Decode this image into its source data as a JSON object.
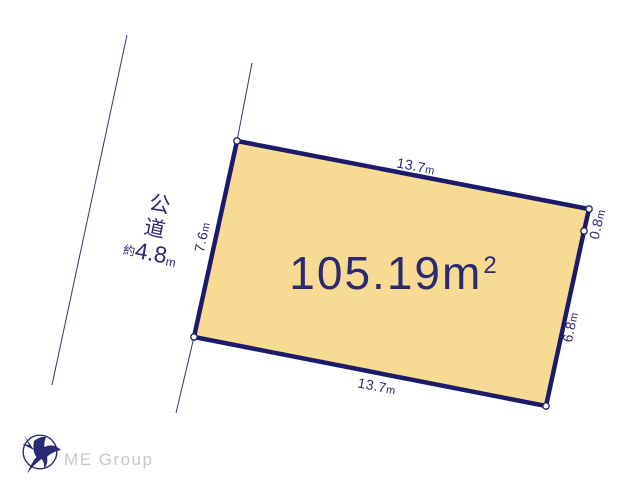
{
  "diagram": {
    "parcel": {
      "area_number": "105.19",
      "area_unit": "m",
      "area_exponent": "2",
      "fill_color": "#F8DA92",
      "outline_color": "#1B1B6B",
      "dimensions": {
        "top": {
          "number": "13.7",
          "unit": "m"
        },
        "right_upper": {
          "number": "0.8",
          "unit": "m"
        },
        "right_lower": {
          "number": "6.8",
          "unit": "m"
        },
        "bottom": {
          "number": "13.7",
          "unit": "m"
        },
        "left": {
          "number": "7.6",
          "unit": "m"
        }
      }
    },
    "road": {
      "name": "公道",
      "width_prefix": "約",
      "width_number": "4.8",
      "width_unit": "m"
    }
  },
  "footer": {
    "company": "ME Group"
  },
  "colors": {
    "ink_navy": "#2A2A74",
    "parcel_fill": "#F8DA92",
    "parcel_border": "#1B1B6B",
    "footer_gray": "#C8C8C8"
  }
}
